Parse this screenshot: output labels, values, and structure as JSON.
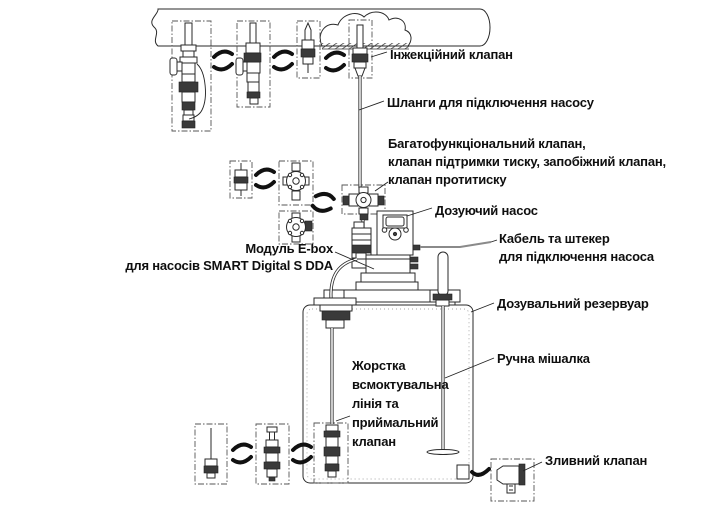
{
  "diagram": {
    "labels": {
      "injection_valve": "Інжекційний клапан",
      "hoses": "Шланги для підключення насосу",
      "multifunction_valve": {
        "line1": "Багатофункціональний клапан,",
        "line2": "клапан підтримки тиску, запобіжний клапан,",
        "line3": "клапан протитиску"
      },
      "dosing_pump": "Дозуючий насос",
      "cable": {
        "line1": "Кабель та штекер",
        "line2": "для підключення насоса"
      },
      "ebox": {
        "line1": "Модуль E-box",
        "line2": "для насосів SMART Digital S DDA"
      },
      "reservoir": "Дозувальний резервуар",
      "mixer": "Ручна мішалка",
      "suction": {
        "line1": "Жорстка",
        "line2": "всмоктувальна",
        "line3": "лінія та",
        "line4": "приймальний",
        "line5": "клапан"
      },
      "drain_valve": "Зливний клапан"
    },
    "colors": {
      "ink": "#0f0f0f",
      "line": "#2a2a2a",
      "dark_fill": "#3a3a3a",
      "cable": "#8a8a8a",
      "background": "#ffffff"
    }
  }
}
